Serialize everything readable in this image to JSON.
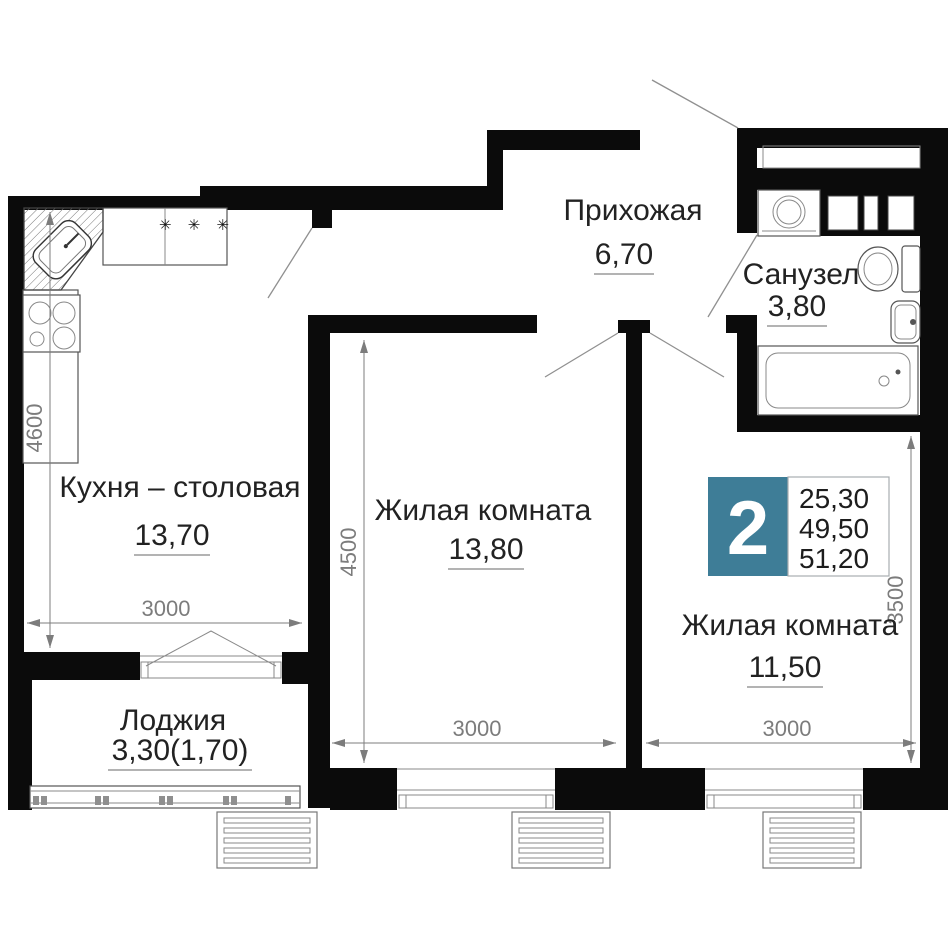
{
  "plan": {
    "title": "2-room apartment floor plan",
    "badge": {
      "rooms_count": "2",
      "area_living": "25,30",
      "area_usable": "49,50",
      "area_total": "51,20"
    },
    "rooms": [
      {
        "name": "Прихожая",
        "area": "6,70"
      },
      {
        "name": "Санузел",
        "area": "3,80"
      },
      {
        "name": "Кухня – столовая",
        "area": "13,70"
      },
      {
        "name": "Жилая комната",
        "area": "13,80"
      },
      {
        "name": "Жилая комната",
        "area": "11,50"
      },
      {
        "name": "Лоджия",
        "area": "3,30(1,70)"
      }
    ],
    "dimensions": {
      "kitchen_height": "4600",
      "kitchen_width": "3000",
      "room1_height": "4500",
      "room1_width": "3000",
      "room2_width": "3000",
      "room2_height": "3500"
    },
    "symbols": {
      "stove_marks": "✳ ✳ ✳"
    },
    "fixtures": [
      "corner-sink",
      "stove",
      "kitchen-counter",
      "balcony-door",
      "loggia-glazing",
      "radiator-basket",
      "window",
      "washing-machine",
      "vent-shaft",
      "toilet",
      "wash-basin",
      "bathtub",
      "door-swing"
    ],
    "colors": {
      "wall": "#0b0b0b",
      "badge_teal": "#3e7d97",
      "dimension_gray": "#7c7c7c",
      "label_dark": "#222222"
    }
  }
}
